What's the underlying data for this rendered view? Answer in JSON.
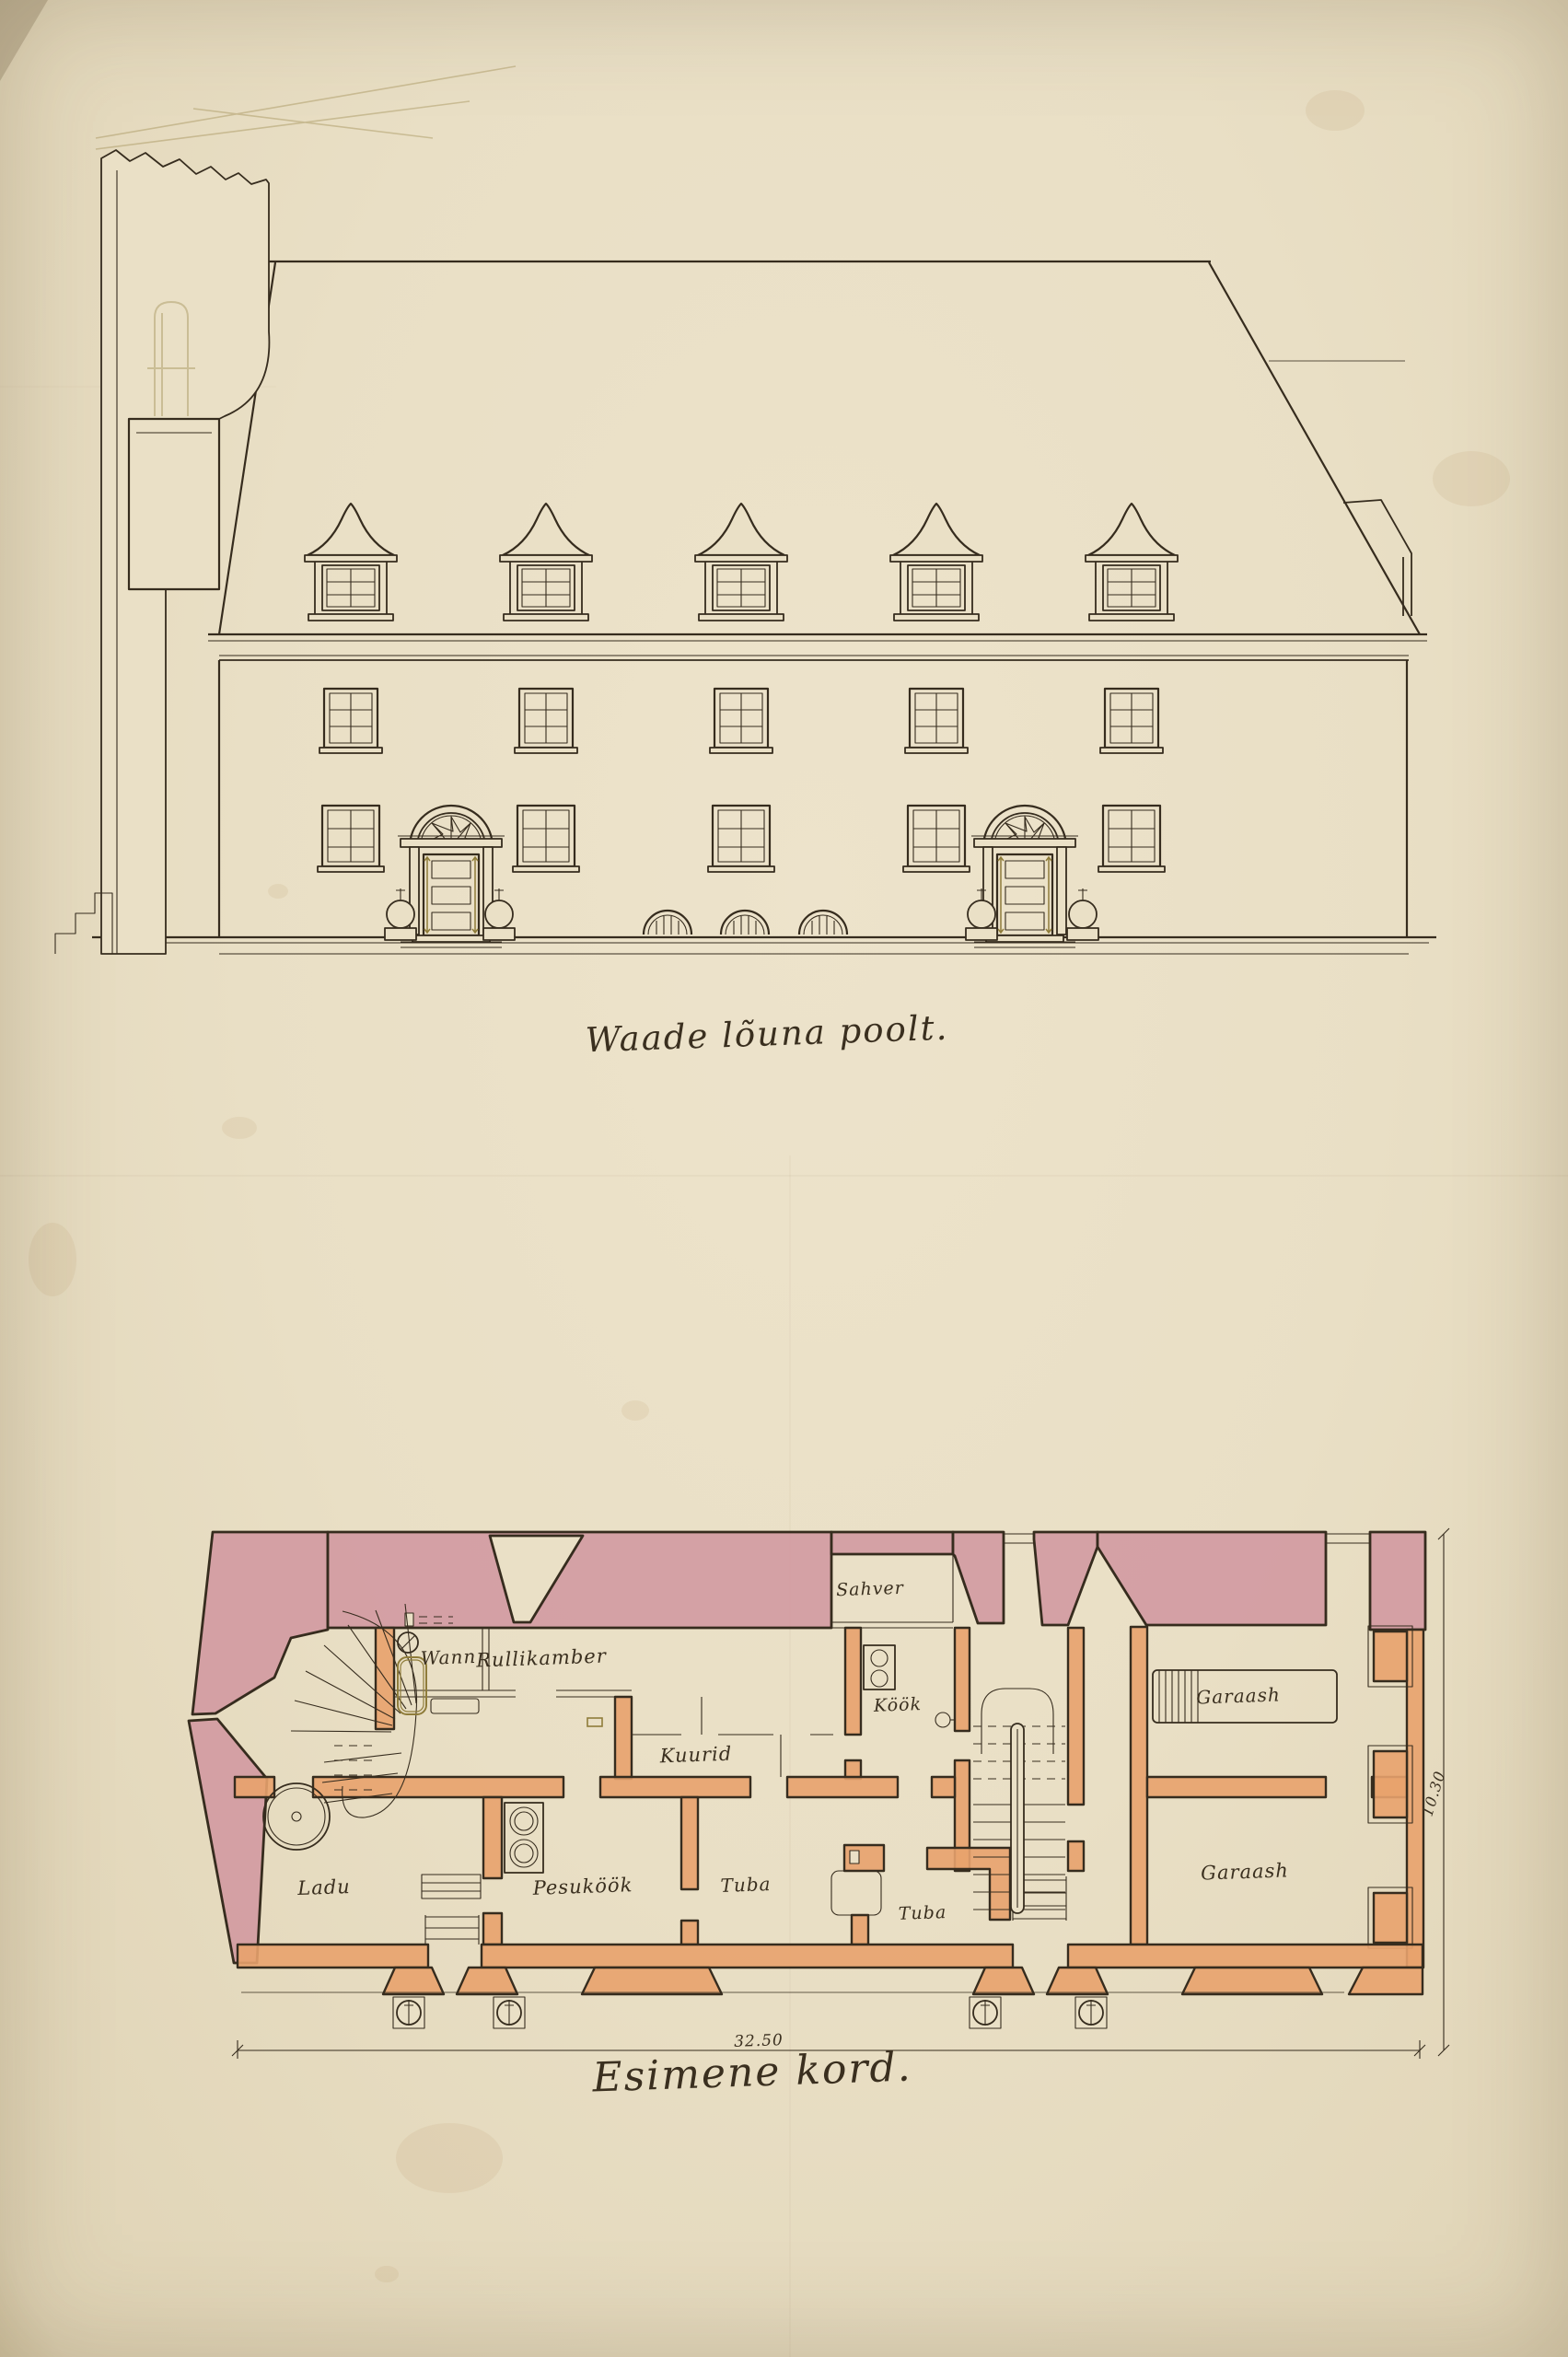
{
  "drawing": {
    "elevation": {
      "caption": "Waade lõuna poolt."
    },
    "plan": {
      "caption": "Esimene kord.",
      "rooms": [
        {
          "label": "Wann"
        },
        {
          "label": "Rullikamber"
        },
        {
          "label": "Sahver"
        },
        {
          "label": "Köök"
        },
        {
          "label": "Kuurid"
        },
        {
          "label": "Garaash"
        },
        {
          "label": "Ladu"
        },
        {
          "label": "Pesuköök"
        },
        {
          "label": "Tuba"
        },
        {
          "label": "Tuba"
        },
        {
          "label": "Garaash"
        }
      ],
      "dimensions": {
        "width": "32.50",
        "height": "10.30"
      }
    }
  },
  "colors": {
    "paper": "#eae0c6",
    "ink": "#362c1e",
    "pink_wash": "#d0929e",
    "orange_wash": "#e8a26d",
    "olive_ink": "#8f7c3a"
  }
}
